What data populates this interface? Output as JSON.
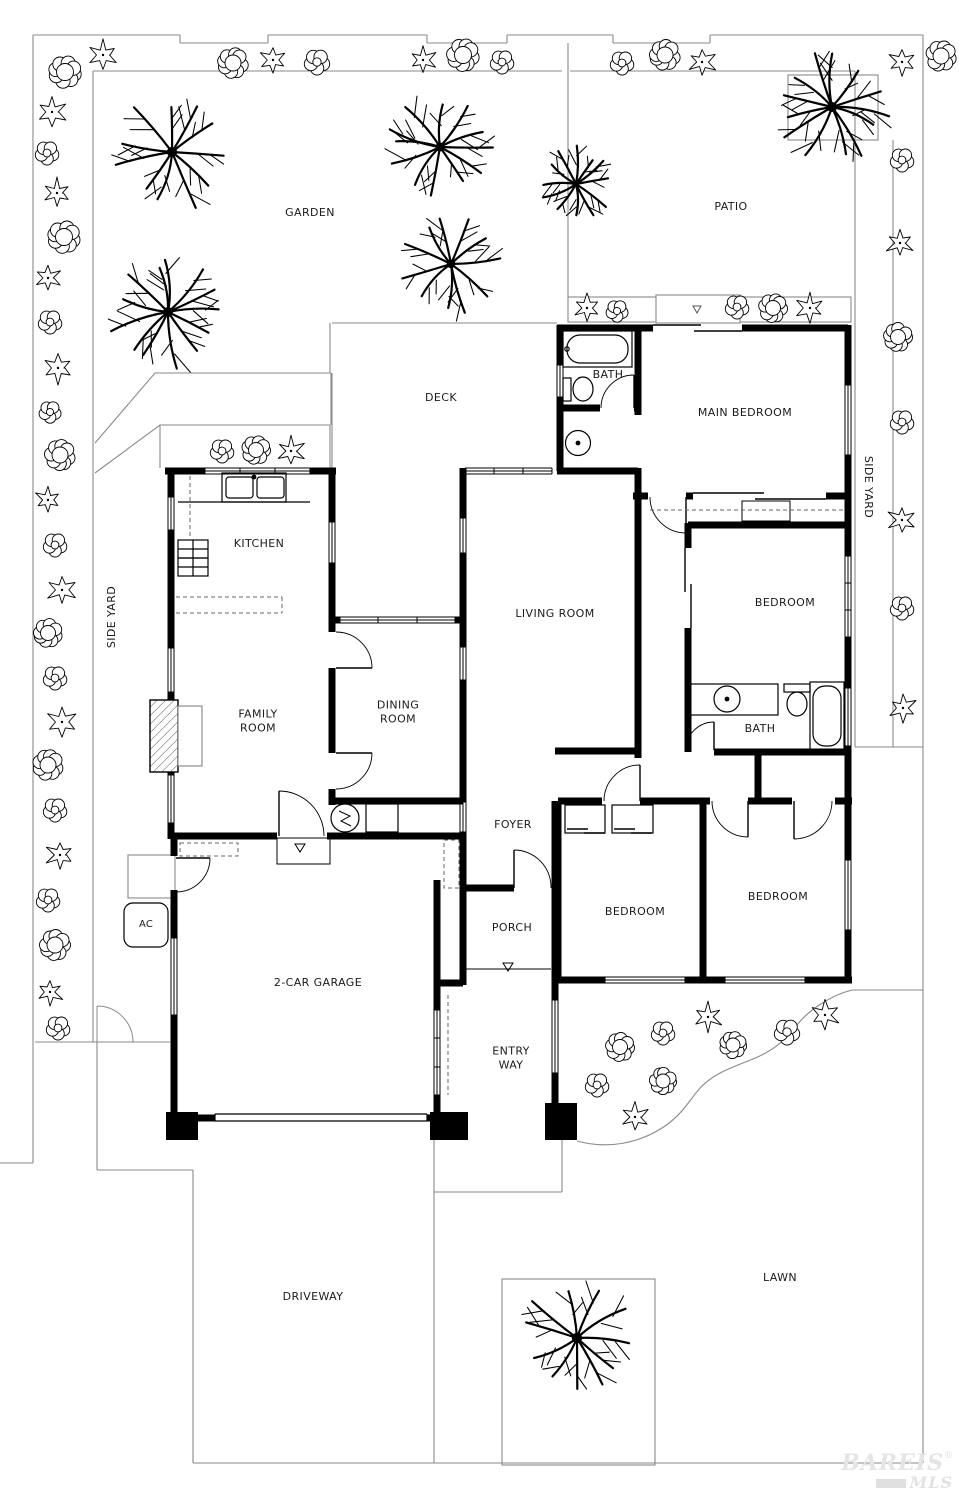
{
  "labels": {
    "garden": "GARDEN",
    "patio": "PATIO",
    "deck": "DECK",
    "bath_main": "BATH",
    "main_bedroom": "MAIN BEDROOM",
    "side_yard_right": "SIDE YARD",
    "side_yard_left": "SIDE YARD",
    "kitchen": "KITCHEN",
    "living_room": "LIVING ROOM",
    "bedroom_mid": "BEDROOM",
    "dining_room": "DINING ROOM",
    "family_room": "FAMILY ROOM",
    "bath2": "BATH",
    "foyer": "FOYER",
    "bedroom_bottom_mid": "BEDROOM",
    "bedroom_bottom_right": "BEDROOM",
    "porch": "PORCH",
    "garage": "2-CAR GARAGE",
    "ac": "AC",
    "entry_way": "ENTRY WAY",
    "driveway": "DRIVEWAY",
    "lawn": "LAWN"
  },
  "watermark": {
    "name": "BAREIS",
    "reg": "®",
    "sub": "MLS"
  },
  "landscape": {
    "trees": [
      {
        "x": 172,
        "y": 152,
        "r": 57
      },
      {
        "x": 440,
        "y": 147,
        "r": 50
      },
      {
        "x": 168,
        "y": 312,
        "r": 56
      },
      {
        "x": 451,
        "y": 264,
        "r": 47
      },
      {
        "x": 576,
        "y": 184,
        "r": 36
      },
      {
        "x": 832,
        "y": 107,
        "r": 55
      },
      {
        "x": 577,
        "y": 1338,
        "r": 58
      }
    ],
    "shrubs": [
      {
        "x": 65,
        "y": 72,
        "v": "a",
        "r": 17
      },
      {
        "x": 103,
        "y": 55,
        "v": "b",
        "r": 15
      },
      {
        "x": 233,
        "y": 63,
        "v": "a",
        "r": 16
      },
      {
        "x": 273,
        "y": 60,
        "v": "b",
        "r": 14
      },
      {
        "x": 317,
        "y": 62,
        "v": "c",
        "r": 14
      },
      {
        "x": 423,
        "y": 60,
        "v": "b",
        "r": 14
      },
      {
        "x": 463,
        "y": 55,
        "v": "a",
        "r": 17
      },
      {
        "x": 502,
        "y": 62,
        "v": "c",
        "r": 13
      },
      {
        "x": 622,
        "y": 63,
        "v": "c",
        "r": 13
      },
      {
        "x": 665,
        "y": 55,
        "v": "a",
        "r": 16
      },
      {
        "x": 702,
        "y": 62,
        "v": "b",
        "r": 14
      },
      {
        "x": 902,
        "y": 62,
        "v": "b",
        "r": 14
      },
      {
        "x": 941,
        "y": 56,
        "v": "a",
        "r": 16
      },
      {
        "x": 52,
        "y": 112,
        "v": "b",
        "r": 15
      },
      {
        "x": 47,
        "y": 153,
        "v": "c",
        "r": 13
      },
      {
        "x": 57,
        "y": 193,
        "v": "b",
        "r": 14
      },
      {
        "x": 64,
        "y": 237,
        "v": "a",
        "r": 17
      },
      {
        "x": 48,
        "y": 278,
        "v": "b",
        "r": 13
      },
      {
        "x": 50,
        "y": 322,
        "v": "c",
        "r": 13
      },
      {
        "x": 58,
        "y": 368,
        "v": "b",
        "r": 15
      },
      {
        "x": 50,
        "y": 412,
        "v": "c",
        "r": 12
      },
      {
        "x": 60,
        "y": 455,
        "v": "a",
        "r": 16
      },
      {
        "x": 48,
        "y": 500,
        "v": "b",
        "r": 13
      },
      {
        "x": 55,
        "y": 545,
        "v": "c",
        "r": 13
      },
      {
        "x": 62,
        "y": 590,
        "v": "b",
        "r": 15
      },
      {
        "x": 48,
        "y": 633,
        "v": "a",
        "r": 15
      },
      {
        "x": 55,
        "y": 678,
        "v": "c",
        "r": 13
      },
      {
        "x": 62,
        "y": 722,
        "v": "b",
        "r": 15
      },
      {
        "x": 48,
        "y": 765,
        "v": "a",
        "r": 16
      },
      {
        "x": 55,
        "y": 810,
        "v": "c",
        "r": 13
      },
      {
        "x": 60,
        "y": 855,
        "v": "b",
        "r": 14
      },
      {
        "x": 48,
        "y": 900,
        "v": "c",
        "r": 13
      },
      {
        "x": 55,
        "y": 945,
        "v": "a",
        "r": 16
      },
      {
        "x": 50,
        "y": 992,
        "v": "b",
        "r": 13
      },
      {
        "x": 58,
        "y": 1028,
        "v": "c",
        "r": 13
      },
      {
        "x": 902,
        "y": 160,
        "v": "c",
        "r": 13
      },
      {
        "x": 900,
        "y": 243,
        "v": "b",
        "r": 14
      },
      {
        "x": 898,
        "y": 337,
        "v": "a",
        "r": 15
      },
      {
        "x": 902,
        "y": 422,
        "v": "c",
        "r": 13
      },
      {
        "x": 902,
        "y": 520,
        "v": "b",
        "r": 14
      },
      {
        "x": 902,
        "y": 608,
        "v": "c",
        "r": 13
      },
      {
        "x": 903,
        "y": 708,
        "v": "b",
        "r": 14
      },
      {
        "x": 222,
        "y": 451,
        "v": "c",
        "r": 13
      },
      {
        "x": 256,
        "y": 450,
        "v": "a",
        "r": 15
      },
      {
        "x": 291,
        "y": 451,
        "v": "b",
        "r": 14
      },
      {
        "x": 587,
        "y": 308,
        "v": "b",
        "r": 14
      },
      {
        "x": 617,
        "y": 311,
        "v": "c",
        "r": 12
      },
      {
        "x": 737,
        "y": 307,
        "v": "c",
        "r": 13
      },
      {
        "x": 773,
        "y": 308,
        "v": "a",
        "r": 15
      },
      {
        "x": 810,
        "y": 308,
        "v": "b",
        "r": 14
      },
      {
        "x": 620,
        "y": 1047,
        "v": "a",
        "r": 15
      },
      {
        "x": 663,
        "y": 1033,
        "v": "c",
        "r": 13
      },
      {
        "x": 708,
        "y": 1017,
        "v": "b",
        "r": 14
      },
      {
        "x": 733,
        "y": 1045,
        "v": "a",
        "r": 14
      },
      {
        "x": 787,
        "y": 1032,
        "v": "c",
        "r": 14
      },
      {
        "x": 825,
        "y": 1015,
        "v": "b",
        "r": 15
      },
      {
        "x": 597,
        "y": 1085,
        "v": "c",
        "r": 13
      },
      {
        "x": 663,
        "y": 1081,
        "v": "a",
        "r": 14
      },
      {
        "x": 635,
        "y": 1117,
        "v": "b",
        "r": 14
      }
    ]
  },
  "colors": {
    "wall": "#000000",
    "site": "#8a8a8a",
    "text": "#1b1b1b",
    "watermark": "#e4e4e4"
  }
}
